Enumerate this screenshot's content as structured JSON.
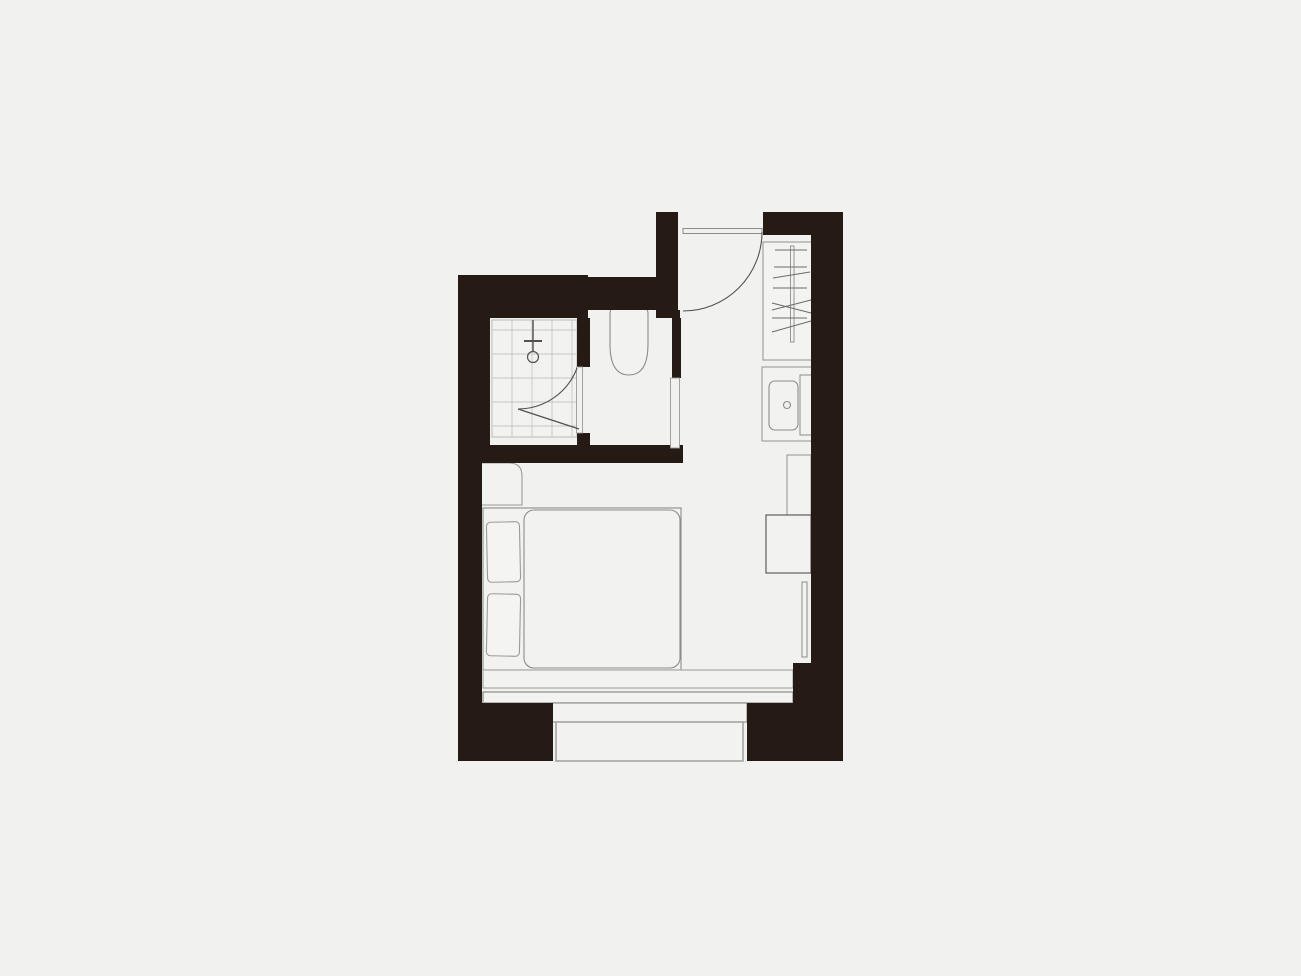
{
  "scene": {
    "type": "architectural-floor-plan",
    "description": "Top-down floor plan of a studio apartment on a plain light-gray background, drawn with dark solid walls and thin gray fixture outlines. No text or dimensions are shown.",
    "rooms": [
      {
        "name": "shower-room",
        "features": [
          "tiled-floor",
          "shower-head",
          "inward-swing-door"
        ]
      },
      {
        "name": "toilet-room",
        "features": [
          "toilet",
          "door-opening-east"
        ]
      },
      {
        "name": "entry-hall",
        "features": [
          "entry-door-with-swing-arc",
          "wardrobe",
          "sink-counter"
        ]
      },
      {
        "name": "living-bedroom",
        "features": [
          "double-bed",
          "two-pillows",
          "duvet",
          "bedside-unit",
          "tall-cabinet",
          "side-unit",
          "radiator",
          "window-bench"
        ]
      },
      {
        "name": "bay-window",
        "features": [
          "two-step-bay",
          "window-line"
        ]
      }
    ],
    "fixtures": [
      "entry-door",
      "entry-door-swing-arc",
      "wardrobe",
      "hanger-rail",
      "hanger-lines",
      "sink-counter",
      "sink-basin",
      "sink-drain",
      "counter-side-board",
      "shower-tile-floor",
      "shower-head",
      "shower-door",
      "shower-door-swing-arc",
      "toilet",
      "wc-door-frame",
      "tall-cabinet",
      "side-unit",
      "radiator",
      "bedside-unit",
      "bed-frame",
      "duvet",
      "pillow-upper",
      "pillow-lower",
      "window-bench-band",
      "window-frame-band",
      "bay-step-outer",
      "bay-step-inner"
    ],
    "text_labels": []
  },
  "colors": {
    "background": "#f1f1f0",
    "wall": "#251a14",
    "line_dark": "#55504c",
    "line_mid": "#8c8c8a",
    "line_light": "#c6c6c4",
    "fixture_fill": "#f2f2f1",
    "pillow_fill": "#f4f4f3"
  },
  "plan": {
    "canvas_width": 1301,
    "canvas_height": 976,
    "offset_x": 455,
    "offset_y": 210,
    "width": 390,
    "height": 553,
    "walls": [
      {
        "name": "wall-bath-west",
        "rect": [
          3,
          65,
          32,
          188
        ]
      },
      {
        "name": "wall-left-lower",
        "rect": [
          3,
          235,
          24,
          316
        ]
      },
      {
        "name": "wall-shower-top",
        "rect": [
          3,
          65,
          130,
          43
        ]
      },
      {
        "name": "wall-wc-top",
        "rect": [
          133,
          67,
          90,
          33
        ]
      },
      {
        "name": "wall-entry-west",
        "rect": [
          201,
          2,
          22,
          98
        ]
      },
      {
        "name": "wall-entry-west-step",
        "rect": [
          201,
          100,
          24,
          8
        ]
      },
      {
        "name": "wall-partition-upper",
        "rect": [
          122,
          108,
          13,
          49
        ]
      },
      {
        "name": "wall-partition-lower",
        "rect": [
          122,
          223,
          13,
          14
        ]
      },
      {
        "name": "wall-wc-east",
        "rect": [
          217,
          108,
          9,
          60
        ]
      },
      {
        "name": "wall-bath-bottom",
        "rect": [
          25,
          235,
          203,
          18
        ]
      },
      {
        "name": "wall-top-right-band",
        "rect": [
          308,
          2,
          80,
          23
        ]
      },
      {
        "name": "wall-right",
        "rect": [
          356,
          25,
          32,
          428
        ]
      },
      {
        "name": "wall-right-jog",
        "rect": [
          338,
          453,
          50,
          40
        ]
      },
      {
        "name": "wall-bottom-right",
        "rect": [
          292,
          493,
          96,
          58
        ]
      },
      {
        "name": "wall-bottom-left",
        "rect": [
          3,
          493,
          95,
          58
        ]
      }
    ]
  }
}
